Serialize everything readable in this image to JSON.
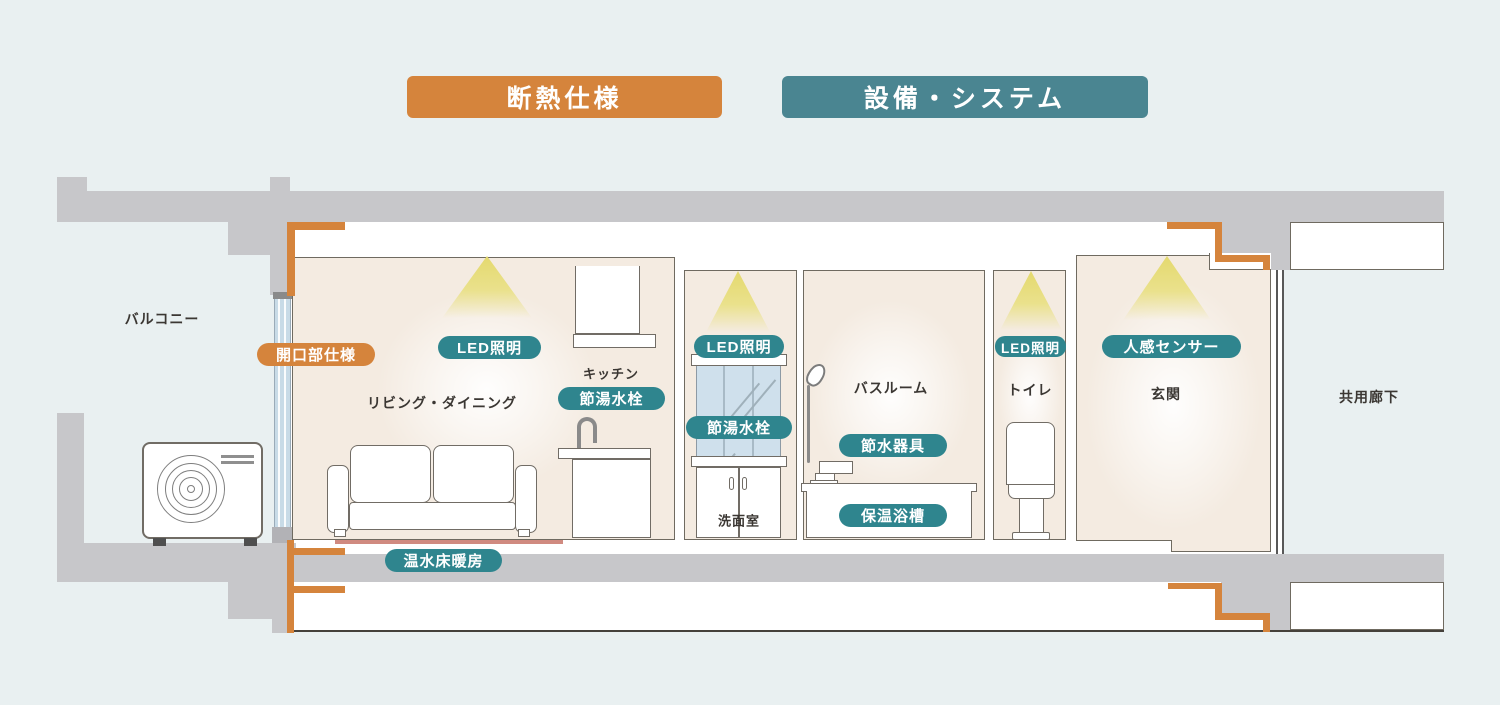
{
  "legend": {
    "insulation": {
      "label": "断熱仕様",
      "color": "#d5843c"
    },
    "equipment": {
      "label": "設備・システム",
      "color": "#4a8591"
    }
  },
  "rooms": {
    "balcony": "バルコニー",
    "living_dining": "リビング・ダイニング",
    "kitchen": "キッチン",
    "washroom": "洗面室",
    "bathroom": "バスルーム",
    "toilet": "トイレ",
    "entrance": "玄関",
    "shared_corridor": "共用廊下"
  },
  "features": {
    "opening_spec": "開口部仕様",
    "led_living": "LED照明",
    "faucet_kitchen": "節湯水栓",
    "led_washroom": "LED照明",
    "faucet_washroom": "節湯水栓",
    "water_saving_fixture": "節水器具",
    "insulated_bathtub": "保温浴槽",
    "led_toilet": "LED照明",
    "motion_sensor": "人感センサー",
    "floor_heating": "温水床暖房"
  },
  "colors": {
    "insulation_orange": "#d5843c",
    "equipment_teal": "#2f858e",
    "header_teal": "#4a8591",
    "room_beige": "#f4ebe1",
    "slab_gray": "#c7c7ca",
    "floor_heating_pink": "#d08a80",
    "background": "#e9f0f1"
  }
}
